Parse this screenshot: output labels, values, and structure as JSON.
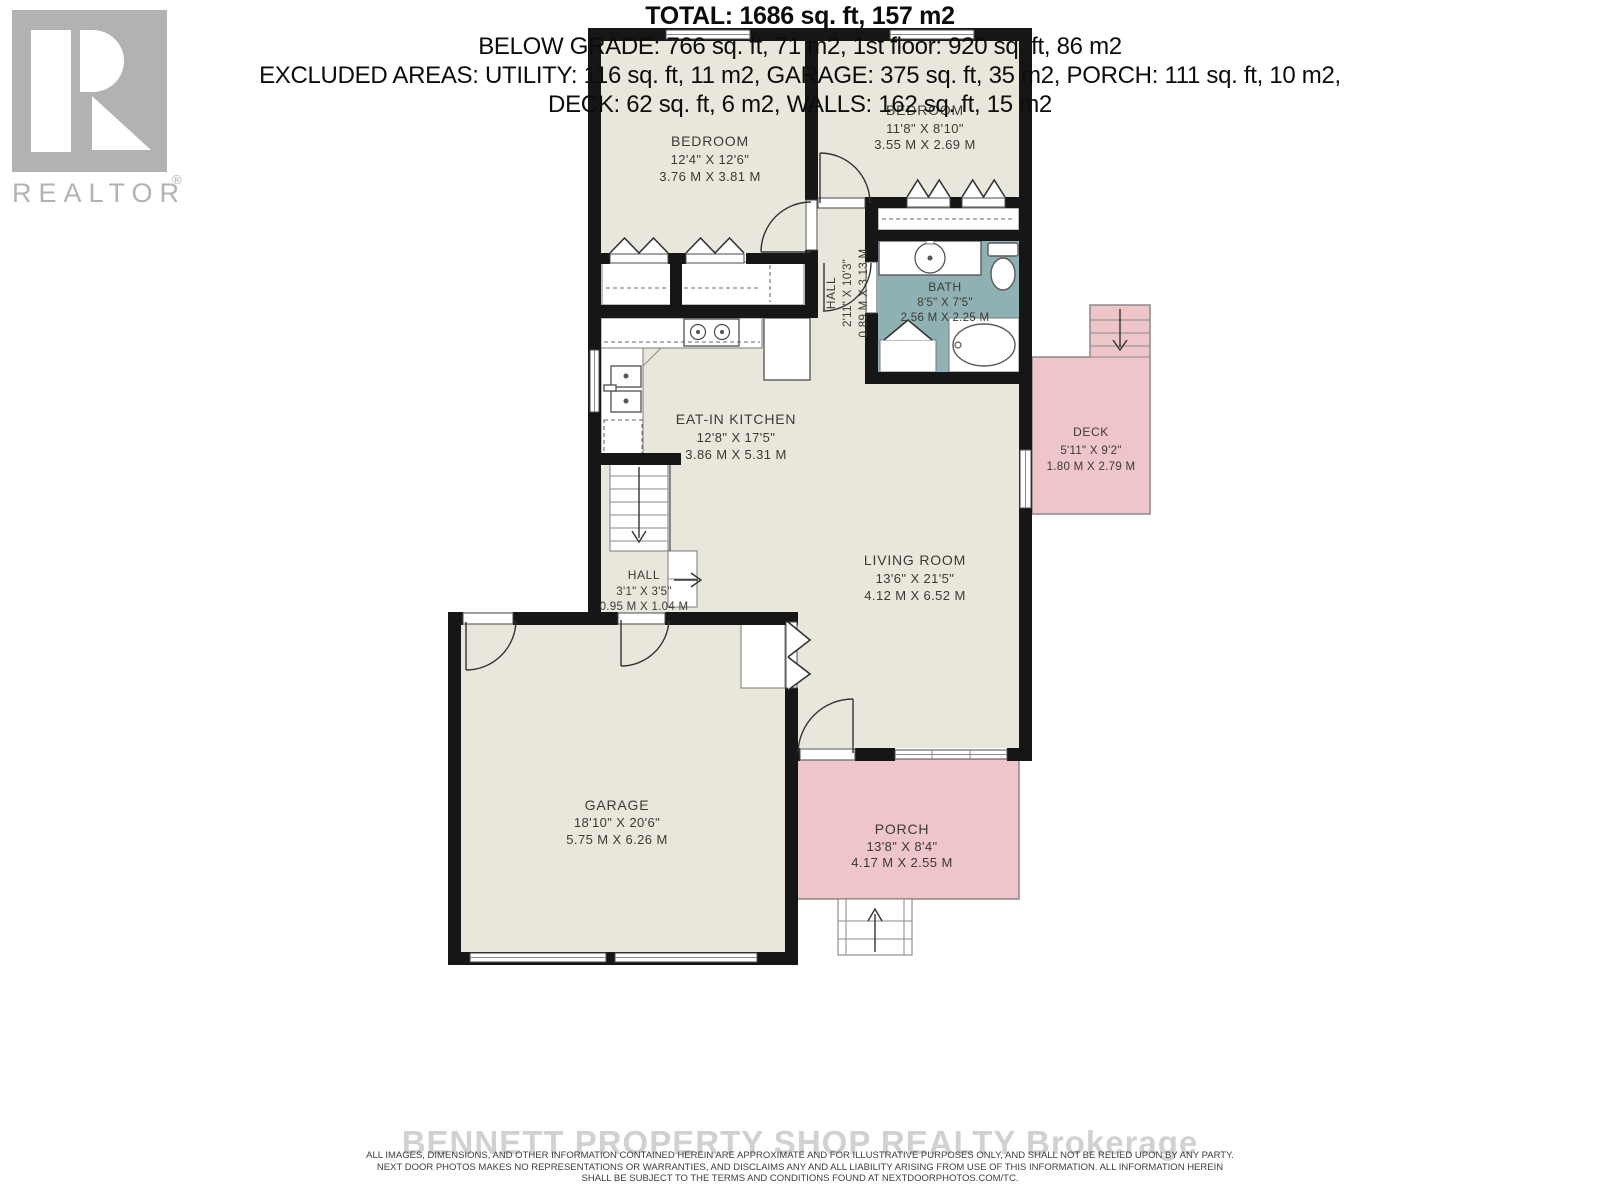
{
  "logo": {
    "brand": "REALTOR",
    "registered": "®"
  },
  "colors": {
    "floor": "#e9e7dc",
    "wall": "#161616",
    "bath": "#8fb1b4",
    "outdoor_pink": "#eec5c9",
    "logo_gray": "#b2b2b2"
  },
  "rooms": {
    "bedroom1": {
      "name": "BEDROOM",
      "imperial": "12'4\" X 12'6\"",
      "metric": "3.76 M X 3.81 M"
    },
    "bedroom2": {
      "name": "BEDROOM",
      "imperial": "11'8\" X 8'10\"",
      "metric": "3.55 M X 2.69 M"
    },
    "bath": {
      "name": "BATH",
      "imperial": "8'5\" X 7'5\"",
      "metric": "2.56 M X 2.25 M"
    },
    "hall_upper": {
      "name": "HALL",
      "imperial": "2'11\" X 10'3\"",
      "metric": "0.89 M X 3.13 M"
    },
    "kitchen": {
      "name": "EAT-IN KITCHEN",
      "imperial": "12'8\" X 17'5\"",
      "metric": "3.86 M X 5.31 M"
    },
    "deck": {
      "name": "DECK",
      "imperial": "5'11\" X 9'2\"",
      "metric": "1.80 M X 2.79 M"
    },
    "living": {
      "name": "LIVING ROOM",
      "imperial": "13'6\" X 21'5\"",
      "metric": "4.12 M X 6.52 M"
    },
    "hall_lower": {
      "name": "HALL",
      "imperial": "3'1\" X 3'5\"",
      "metric": "0.95 M X 1.04 M"
    },
    "garage": {
      "name": "GARAGE",
      "imperial": "18'10\" X 20'6\"",
      "metric": "5.75 M X 6.26 M"
    },
    "porch": {
      "name": "PORCH",
      "imperial": "13'8\" X 8'4\"",
      "metric": "4.17 M X 2.55 M"
    }
  },
  "summary": {
    "total": "TOTAL: 1686 sq. ft, 157 m2",
    "below": "BELOW GRADE: 766 sq. ft, 71 m2, 1st floor: 920 sq. ft, 86 m2",
    "excluded1": "EXCLUDED AREAS: UTILITY: 116 sq. ft, 11 m2, GARAGE: 375 sq. ft, 35 m2, PORCH: 111 sq. ft, 10 m2,",
    "excluded2": "DECK: 62 sq. ft, 6 m2, WALLS: 162 sq. ft, 15 m2"
  },
  "watermark": "BENNETT PROPERTY SHOP REALTY Brokerage",
  "disclaimer": {
    "line1": "ALL IMAGES, DIMENSIONS, AND OTHER INFORMATION CONTAINED HEREIN ARE APPROXIMATE AND FOR ILLUSTRATIVE PURPOSES ONLY, AND SHALL NOT BE RELIED UPON BY ANY PARTY.",
    "line2": "NEXT DOOR PHOTOS MAKES NO REPRESENTATIONS OR WARRANTIES, AND DISCLAIMS ANY AND ALL LIABILITY ARISING FROM USE OF THIS INFORMATION. ALL INFORMATION HEREIN",
    "line3": "SHALL BE SUBJECT TO THE TERMS AND CONDITIONS FOUND AT NEXTDOORPHOTOS.COM/TC."
  }
}
